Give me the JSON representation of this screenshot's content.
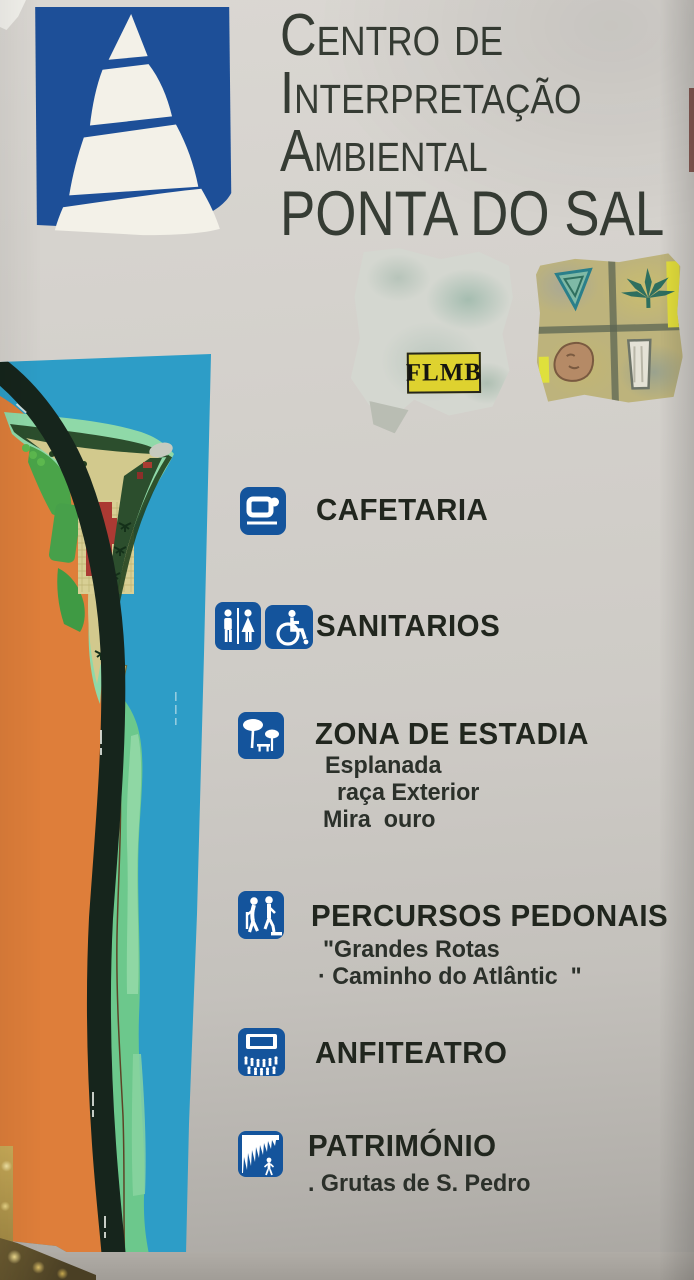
{
  "sign": {
    "title": {
      "line1": "Centro de",
      "line2": "Interpretação",
      "line3": "Ambiental",
      "line4": "PONTA DO SAL"
    }
  },
  "stickers": {
    "flmb_label": "FLMB",
    "grid_sticker_symbols": [
      "inverted-triangle-icon",
      "cannabis-leaf-icon",
      "face-icon",
      "glass-icon"
    ]
  },
  "legend": {
    "items": [
      {
        "icons": [
          "coffee-cup-icon"
        ],
        "label": "CAFETARIA",
        "subs": []
      },
      {
        "icons": [
          "restroom-icon",
          "wheelchair-icon"
        ],
        "label": "SANITARIOS",
        "subs": []
      },
      {
        "icons": [
          "picnic-area-icon"
        ],
        "label": "ZONA DE ESTADIA",
        "subs": [
          "Esplanada",
          "raça Exterior",
          "Mira  ouro"
        ]
      },
      {
        "icons": [
          "walking-people-icon"
        ],
        "label": "PERCURSOS PEDONAIS",
        "subs": [
          "\"Grandes Rotas",
          "· Caminho do Atlântic  \""
        ]
      },
      {
        "icons": [
          "amphitheater-icon"
        ],
        "label": "ANFITEATRO",
        "subs": []
      },
      {
        "icons": [
          "cave-icon"
        ],
        "label": "PATRIMÓNIO",
        "subs": [
          ". Grutas de S. Pedro"
        ]
      }
    ]
  },
  "colors": {
    "icon_blue": "#14549c",
    "logo_blue": "#1d4f98",
    "water_blue": "#2d9dc7",
    "land_orange": "#de7e3a",
    "road_dark": "#16251c",
    "coast_green": "#6cc88c",
    "beach_mint": "#8fd9a8",
    "vegetation_dark": "#2c4e2d",
    "building_red": "#ab3a33",
    "path_tan": "#d2c98d",
    "flmb_yellow": "#ded22f",
    "sign_gray": "#cecbc6",
    "title_gray": "#363c34",
    "text_dark": "#21261e"
  }
}
